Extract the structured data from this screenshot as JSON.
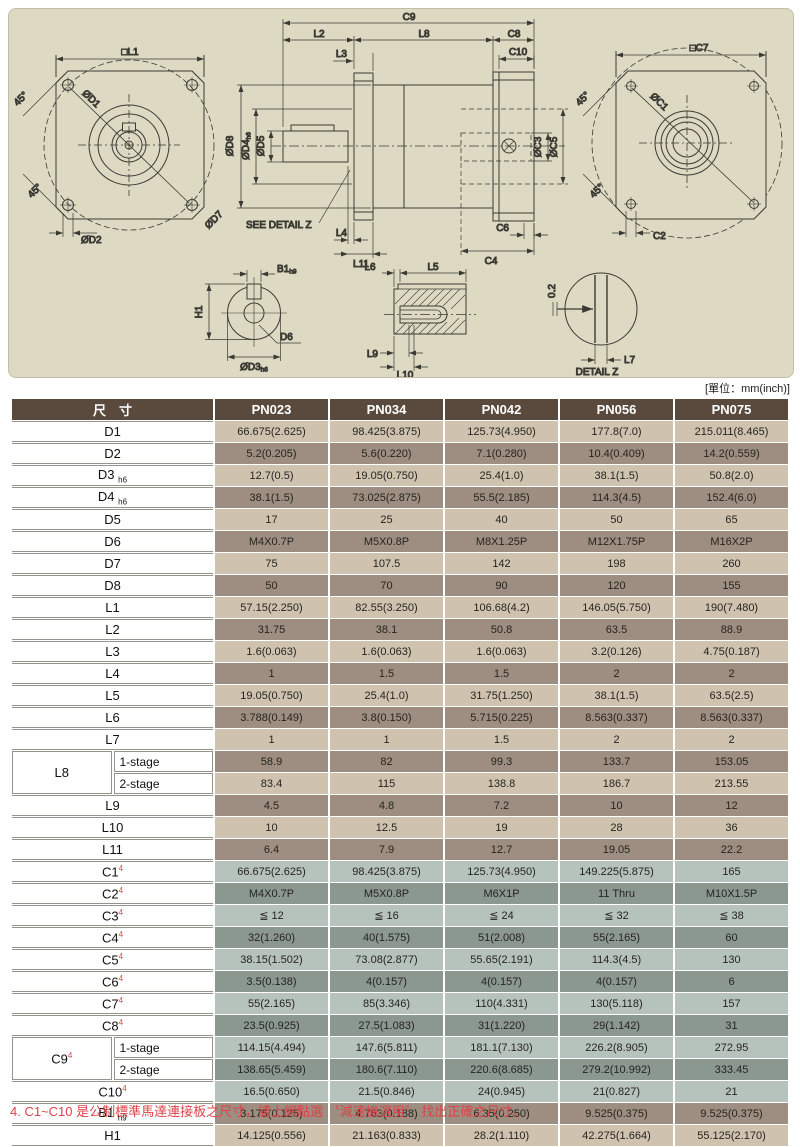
{
  "page": {
    "unit_note": "[單位：mm(inch)]",
    "footnote": "4. C1~C10 是公制標準馬達連接板之尺寸，請上網點選 〝減速機選用〞 找出正確之尺寸。"
  },
  "colors": {
    "header_bg": "#5a4a3e",
    "row_brown_light": "#cfc3b0",
    "row_brown_dark": "#9e8e81",
    "row_green_light": "#b6c3bd",
    "row_green_dark": "#8b988f",
    "note_red": "#dd4348",
    "panel_bg": "#ddd9c3"
  },
  "drawing": {
    "front": {
      "l1": "□L1",
      "d1": "ØD1",
      "d2": "ØD2",
      "d7": "ØD7",
      "a1": "45°",
      "a2": "45°"
    },
    "section": {
      "c9": "C9",
      "l2": "L2",
      "l8": "L8",
      "c8": "C8",
      "l3": "L3",
      "c10": "C10",
      "d8": "ØD8",
      "d4": "ØD4",
      "d4s": "h6",
      "d5": "ØD5",
      "c3": "ØC3",
      "c5": "ØC5",
      "see": "SEE DETAIL Z",
      "l4": "L4",
      "l11": "L11",
      "c6": "C6",
      "c4": "C4"
    },
    "rear": {
      "c7": "□C7",
      "c1": "ØC1",
      "c2": "C2",
      "a1": "45°",
      "a2": "45°"
    },
    "shaft_end": {
      "b1": "B1",
      "b1s": "h9",
      "h1": "H1",
      "d6": "D6",
      "d3": "ØD3",
      "d3s": "h6"
    },
    "shaft_side": {
      "l6": "L6",
      "l5": "L5",
      "l9": "L9",
      "l10": "L10"
    },
    "detail_z": {
      "gap": "0.2",
      "l7": "L7",
      "caption": "DETAIL Z"
    }
  },
  "table": {
    "header": {
      "dim_label": "尺　寸",
      "columns": [
        "PN023",
        "PN034",
        "PN042",
        "PN056",
        "PN075"
      ]
    },
    "rows": [
      {
        "label": "D1",
        "shade": "bl",
        "values": [
          "66.675(2.625)",
          "98.425(3.875)",
          "125.73(4.950)",
          "177.8(7.0)",
          "215.011(8.465)"
        ]
      },
      {
        "label": "D2",
        "shade": "bd",
        "values": [
          "5.2(0.205)",
          "5.6(0.220)",
          "7.1(0.280)",
          "10.4(0.409)",
          "14.2(0.559)"
        ]
      },
      {
        "label": "D3",
        "sub": "h6",
        "shade": "bl",
        "values": [
          "12.7(0.5)",
          "19.05(0.750)",
          "25.4(1.0)",
          "38.1(1.5)",
          "50.8(2.0)"
        ]
      },
      {
        "label": "D4",
        "sub": "h6",
        "shade": "bd",
        "values": [
          "38.1(1.5)",
          "73.025(2.875)",
          "55.5(2.185)",
          "114.3(4.5)",
          "152.4(6.0)"
        ]
      },
      {
        "label": "D5",
        "shade": "bl",
        "values": [
          "17",
          "25",
          "40",
          "50",
          "65"
        ]
      },
      {
        "label": "D6",
        "shade": "bd",
        "values": [
          "M4X0.7P",
          "M5X0.8P",
          "M8X1.25P",
          "M12X1.75P",
          "M16X2P"
        ]
      },
      {
        "label": "D7",
        "shade": "bl",
        "values": [
          "75",
          "107.5",
          "142",
          "198",
          "260"
        ]
      },
      {
        "label": "D8",
        "shade": "bd",
        "values": [
          "50",
          "70",
          "90",
          "120",
          "155"
        ]
      },
      {
        "label": "L1",
        "shade": "bl",
        "values": [
          "57.15(2.250)",
          "82.55(3.250)",
          "106.68(4.2)",
          "146.05(5.750)",
          "190(7.480)"
        ]
      },
      {
        "label": "L2",
        "shade": "bd",
        "values": [
          "31.75",
          "38.1",
          "50.8",
          "63.5",
          "88.9"
        ]
      },
      {
        "label": "L3",
        "shade": "bl",
        "values": [
          "1.6(0.063)",
          "1.6(0.063)",
          "1.6(0.063)",
          "3.2(0.126)",
          "4.75(0.187)"
        ]
      },
      {
        "label": "L4",
        "shade": "bd",
        "values": [
          "1",
          "1.5",
          "1.5",
          "2",
          "2"
        ]
      },
      {
        "label": "L5",
        "shade": "bl",
        "values": [
          "19.05(0.750)",
          "25.4(1.0)",
          "31.75(1.250)",
          "38.1(1.5)",
          "63.5(2.5)"
        ]
      },
      {
        "label": "L6",
        "shade": "bd",
        "values": [
          "3.788(0.149)",
          "3.8(0.150)",
          "5.715(0.225)",
          "8.563(0.337)",
          "8.563(0.337)"
        ]
      },
      {
        "label": "L7",
        "shade": "bl",
        "values": [
          "1",
          "1",
          "1.5",
          "2",
          "2"
        ]
      },
      {
        "label": "L8",
        "group": "L8",
        "stage": "1-stage",
        "shade": "bd",
        "values": [
          "58.9",
          "82",
          "99.3",
          "133.7",
          "153.05"
        ]
      },
      {
        "label": "L8",
        "group": "L8",
        "stage": "2-stage",
        "shade": "bl",
        "values": [
          "83.4",
          "115",
          "138.8",
          "186.7",
          "213.55"
        ]
      },
      {
        "label": "L9",
        "shade": "bd",
        "values": [
          "4.5",
          "4.8",
          "7.2",
          "10",
          "12"
        ]
      },
      {
        "label": "L10",
        "shade": "bl",
        "values": [
          "10",
          "12.5",
          "19",
          "28",
          "36"
        ]
      },
      {
        "label": "L11",
        "shade": "bd",
        "values": [
          "6.4",
          "7.9",
          "12.7",
          "19.05",
          "22.2"
        ]
      },
      {
        "label": "C1",
        "sup": "4",
        "shade": "gl",
        "values": [
          "66.675(2.625)",
          "98.425(3.875)",
          "125.73(4.950)",
          "149.225(5.875)",
          "165"
        ]
      },
      {
        "label": "C2",
        "sup": "4",
        "shade": "gd",
        "values": [
          "M4X0.7P",
          "M5X0.8P",
          "M6X1P",
          "11 Thru",
          "M10X1.5P"
        ]
      },
      {
        "label": "C3",
        "sup": "4",
        "shade": "gl",
        "values": [
          "≦ 12",
          "≦ 16",
          "≦ 24",
          "≦ 32",
          "≦ 38"
        ]
      },
      {
        "label": "C4",
        "sup": "4",
        "shade": "gd",
        "values": [
          "32(1.260)",
          "40(1.575)",
          "51(2.008)",
          "55(2.165)",
          "60"
        ]
      },
      {
        "label": "C5",
        "sup": "4",
        "shade": "gl",
        "values": [
          "38.15(1.502)",
          "73.08(2.877)",
          "55.65(2.191)",
          "114.3(4.5)",
          "130"
        ]
      },
      {
        "label": "C6",
        "sup": "4",
        "shade": "gd",
        "values": [
          "3.5(0.138)",
          "4(0.157)",
          "4(0.157)",
          "4(0.157)",
          "6"
        ]
      },
      {
        "label": "C7",
        "sup": "4",
        "shade": "gl",
        "values": [
          "55(2.165)",
          "85(3.346)",
          "110(4.331)",
          "130(5.118)",
          "157"
        ]
      },
      {
        "label": "C8",
        "sup": "4",
        "shade": "gd",
        "values": [
          "23.5(0.925)",
          "27.5(1.083)",
          "31(1.220)",
          "29(1.142)",
          "31"
        ]
      },
      {
        "label": "C9",
        "sup": "4",
        "group": "C9",
        "stage": "1-stage",
        "shade": "gl",
        "values": [
          "114.15(4.494)",
          "147.6(5.811)",
          "181.1(7.130)",
          "226.2(8.905)",
          "272.95"
        ]
      },
      {
        "label": "C9",
        "sup": "4",
        "group": "C9",
        "stage": "2-stage",
        "shade": "gd",
        "values": [
          "138.65(5.459)",
          "180.6(7.110)",
          "220.6(8.685)",
          "279.2(10.992)",
          "333.45"
        ]
      },
      {
        "label": "C10",
        "sup": "4",
        "shade": "gl",
        "values": [
          "16.5(0.650)",
          "21.5(0.846)",
          "24(0.945)",
          "21(0.827)",
          "21"
        ]
      },
      {
        "label": "B1",
        "sub": "h9",
        "shade": "bd",
        "values": [
          "3.175(0.125)",
          "4.763(0.188)",
          "6.35(0.250)",
          "9.525(0.375)",
          "9.525(0.375)"
        ]
      },
      {
        "label": "H1",
        "shade": "bl",
        "values": [
          "14.125(0.556)",
          "21.163(0.833)",
          "28.2(1.110)",
          "42.275(1.664)",
          "55.125(2.170)"
        ]
      }
    ]
  }
}
